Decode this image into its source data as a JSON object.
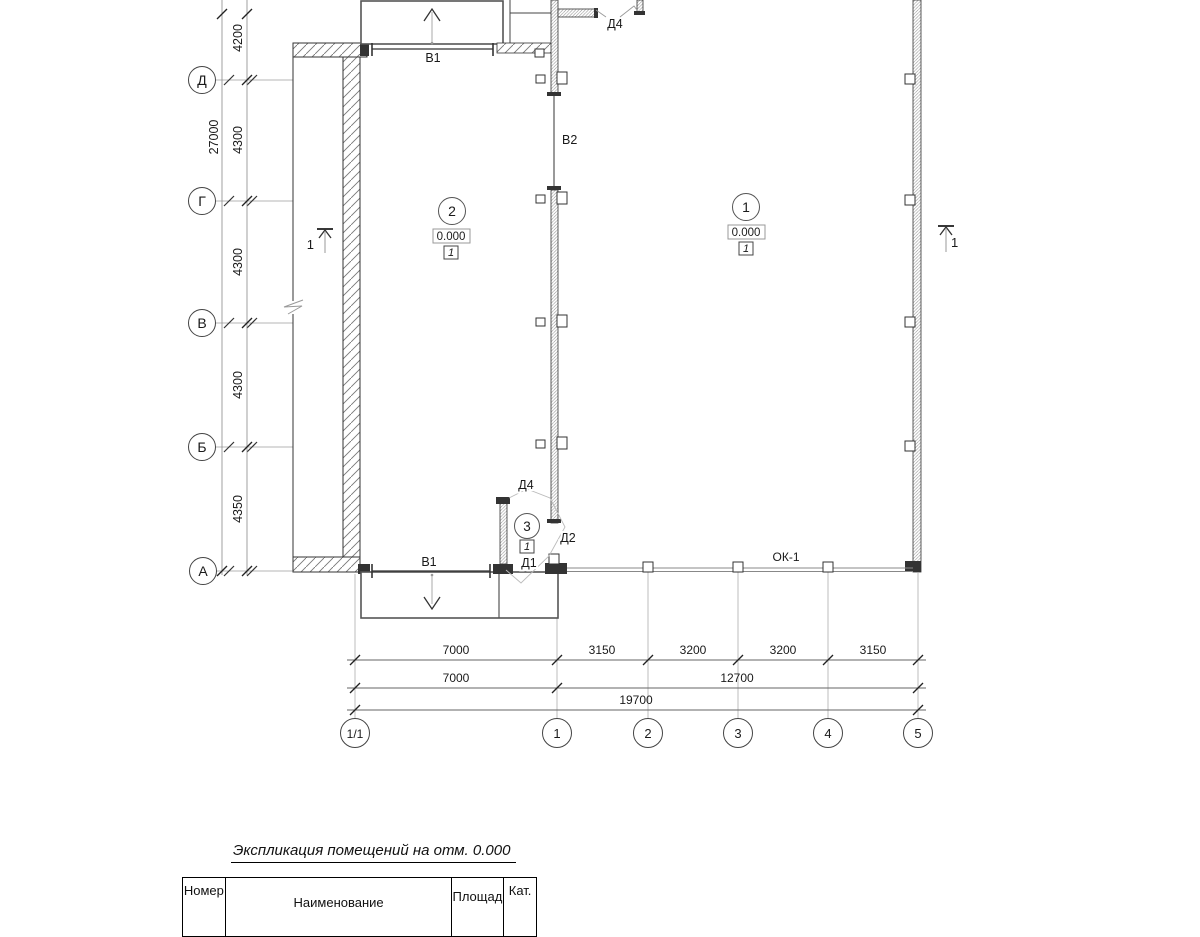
{
  "plan": {
    "grid": {
      "rows": [
        {
          "label": "Д"
        },
        {
          "label": "Г"
        },
        {
          "label": "В"
        },
        {
          "label": "Б"
        },
        {
          "label": "А"
        }
      ],
      "cols": [
        {
          "label": "1/1"
        },
        {
          "label": "1"
        },
        {
          "label": "2"
        },
        {
          "label": "3"
        },
        {
          "label": "4"
        },
        {
          "label": "5"
        }
      ]
    },
    "dims": {
      "vertical": {
        "total": "27000",
        "segments": [
          "4200",
          "4300",
          "4300",
          "4300",
          "4350"
        ]
      },
      "horizontal": {
        "row1": [
          "7000",
          "3150",
          "3200",
          "3200",
          "3150"
        ],
        "row2": [
          "7000",
          "12700"
        ],
        "row3": [
          "19700"
        ]
      }
    },
    "openings": {
      "gate_top": "В1",
      "gate_bottom": "В1",
      "wall_opening": "В2",
      "door_top": "Д4",
      "door_vestibule_top": "Д4",
      "door_vestibule_side": "Д2",
      "door_vestibule_bottom": "Д1",
      "window": "ОК-1"
    },
    "rooms": [
      {
        "number": "1",
        "elevation": "0.000",
        "category": "1"
      },
      {
        "number": "2",
        "elevation": "0.000",
        "category": "1"
      },
      {
        "number": "3",
        "category": "1"
      }
    ],
    "section_marks": {
      "left": "1",
      "right": "1"
    }
  },
  "schedule": {
    "title": "Экспликация помещений на отм. 0.000",
    "columns": [
      "Номер",
      "Наименование",
      "Площадь",
      "Кат."
    ]
  },
  "colors": {
    "line": "#222222",
    "grid_line": "#b5b5b5",
    "hatch": "#777777"
  }
}
